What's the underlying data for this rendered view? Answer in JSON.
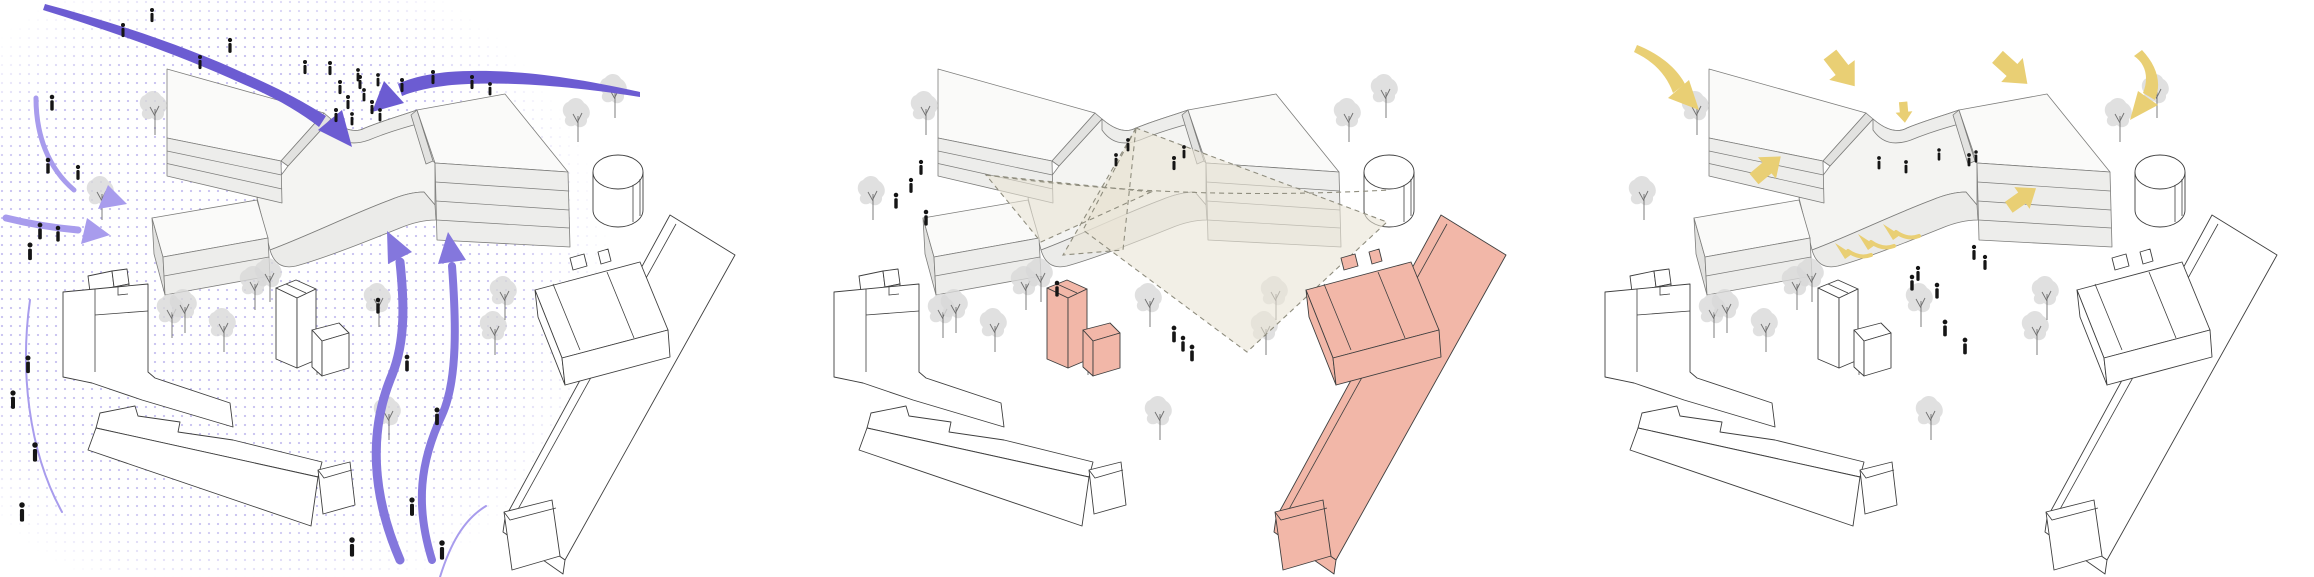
{
  "meta": {
    "type": "architectural-concept-diagram-triptych",
    "view": "axonometric site drawing repeated in three panels with different analytical overlays"
  },
  "panels": [
    {
      "id": "pedestrian-flows",
      "overlay": "purple-flow-arrows-with-dot-texture",
      "people_count": 36
    },
    {
      "id": "sightlines-context",
      "overlay": "beige-dashed-view-cones-and-pink-highlighted-neighbours",
      "people_count": 12
    },
    {
      "id": "sun-entries",
      "overlay": "yellow-block-arrows-into-courtyard",
      "people_count": 12
    }
  ],
  "colors": {
    "flow_primary": "#6c5cd2",
    "flow_light": "#a89ced",
    "flow_medium": "#8477dd",
    "dots": "#c8c2f0",
    "cone": "#e9e4d5",
    "cone_edge": "#8f8d7e",
    "highlight_pink": "#f2b7a8",
    "sun": "#e9cf74",
    "roof": "#fafaf9",
    "face": "#ededeb",
    "face_dark": "#e2e2e0",
    "podium": "#f4f4f2",
    "band": "#ebebe9",
    "context_fill": "#ffffff",
    "line_main": "#7d7d7b",
    "line_ctx": "#3f3f3f",
    "person": "#151515",
    "tree_canopy": "#d8d8d8",
    "tree_trunk": "#707070"
  },
  "trees": [
    [
      155,
      135
    ],
    [
      578,
      142
    ],
    [
      615,
      118
    ],
    [
      102,
      220
    ],
    [
      172,
      338
    ],
    [
      224,
      352
    ],
    [
      255,
      310
    ],
    [
      317,
      375
    ],
    [
      379,
      327
    ],
    [
      495,
      355
    ],
    [
      389,
      440
    ],
    [
      270,
      302
    ],
    [
      185,
      333
    ],
    [
      505,
      320
    ]
  ],
  "people": {
    "panel1": [
      [
        152,
        10,
        0.8
      ],
      [
        123,
        25,
        0.8
      ],
      [
        230,
        40,
        0.85
      ],
      [
        200,
        57,
        0.8
      ],
      [
        305,
        62,
        0.8
      ],
      [
        330,
        63,
        0.8
      ],
      [
        360,
        77,
        0.8
      ],
      [
        378,
        75,
        0.75
      ],
      [
        402,
        80,
        0.8
      ],
      [
        433,
        72,
        0.8
      ],
      [
        472,
        77,
        0.8
      ],
      [
        490,
        84,
        0.75
      ],
      [
        340,
        82,
        0.8
      ],
      [
        348,
        97,
        0.8
      ],
      [
        358,
        70,
        0.75
      ],
      [
        364,
        90,
        0.75
      ],
      [
        372,
        102,
        0.8
      ],
      [
        380,
        110,
        0.75
      ],
      [
        336,
        110,
        0.8
      ],
      [
        352,
        114,
        0.75
      ],
      [
        52,
        97,
        0.9
      ],
      [
        48,
        160,
        0.9
      ],
      [
        78,
        167,
        0.85
      ],
      [
        40,
        225,
        0.95
      ],
      [
        58,
        228,
        0.9
      ],
      [
        30,
        245,
        1
      ],
      [
        28,
        358,
        1
      ],
      [
        13,
        393,
        1.05
      ],
      [
        35,
        445,
        1.1
      ],
      [
        22,
        505,
        1.1
      ],
      [
        378,
        300,
        0.9
      ],
      [
        407,
        357,
        0.95
      ],
      [
        437,
        410,
        1
      ],
      [
        352,
        540,
        1.1
      ],
      [
        412,
        500,
        1.05
      ],
      [
        442,
        543,
        1.1
      ]
    ],
    "panel2": [
      [
        345,
        155,
        0.75
      ],
      [
        357,
        140,
        0.75
      ],
      [
        403,
        158,
        0.8
      ],
      [
        413,
        147,
        0.75
      ],
      [
        150,
        162,
        0.85
      ],
      [
        140,
        180,
        0.85
      ],
      [
        125,
        195,
        0.9
      ],
      [
        155,
        212,
        0.9
      ],
      [
        286,
        283,
        0.9
      ],
      [
        403,
        328,
        0.95
      ],
      [
        412,
        338,
        0.9
      ],
      [
        421,
        347,
        0.95
      ]
    ],
    "panel3": [
      [
        337,
        158,
        0.75
      ],
      [
        364,
        162,
        0.75
      ],
      [
        397,
        150,
        0.7
      ],
      [
        427,
        155,
        0.75
      ],
      [
        434,
        152,
        0.7
      ],
      [
        432,
        247,
        0.85
      ],
      [
        443,
        257,
        0.85
      ],
      [
        370,
        277,
        0.9
      ],
      [
        376,
        268,
        0.85
      ],
      [
        395,
        285,
        0.9
      ],
      [
        403,
        322,
        0.95
      ],
      [
        423,
        340,
        0.95
      ]
    ]
  },
  "sun": {
    "block_arrows": [
      {
        "x": 300,
        "y": 70,
        "rot": -38,
        "s": 1.15
      },
      {
        "x": 362,
        "y": 112,
        "rot": -5,
        "s": 0.6
      },
      {
        "x": 470,
        "y": 70,
        "rot": -48,
        "s": 1.15
      },
      {
        "x": 225,
        "y": 168,
        "rot": 230,
        "s": 1.0
      },
      {
        "x": 480,
        "y": 198,
        "rot": 235,
        "s": 0.95
      }
    ],
    "sprigs": [
      {
        "x": 300,
        "y": 247,
        "rot": 0,
        "s": 1
      },
      {
        "x": 323,
        "y": 238,
        "rot": 0,
        "s": 1
      },
      {
        "x": 348,
        "y": 228,
        "rot": 0,
        "s": 1
      }
    ]
  }
}
